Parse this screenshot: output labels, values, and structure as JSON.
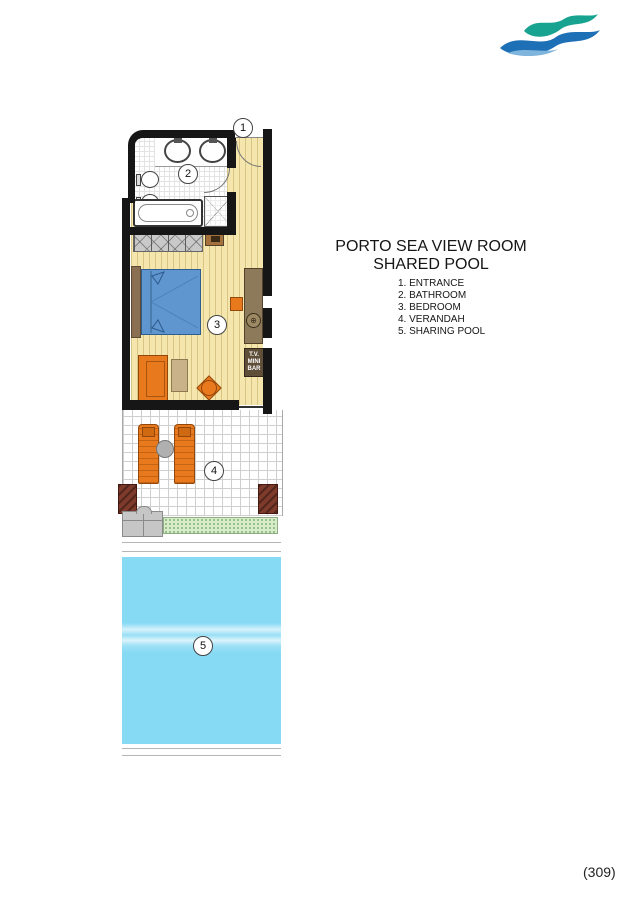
{
  "logo": {
    "brand": "porto elounda",
    "tagline": "GOLF & SPA RESORT",
    "colors": {
      "wave_teal": "#18a390",
      "wave_blue": "#1d6fb6",
      "brand_text": "#23386b",
      "tagline_text": "#a49b89"
    }
  },
  "title": {
    "line1": "PORTO SEA VIEW ROOM",
    "line2": "SHARED POOL"
  },
  "legend": {
    "items": [
      "1. ENTRANCE",
      "2. BATHROOM",
      "3. BEDROOM",
      "4. VERANDAH",
      "5. SHARING POOL"
    ]
  },
  "plan": {
    "markers": [
      "1",
      "2",
      "3",
      "4",
      "5"
    ],
    "tv_cabinet_lines": [
      "T.V.",
      "MINI",
      "BAR"
    ],
    "colors": {
      "wall": "#161616",
      "wood_floor": "#f4e6ac",
      "bed": "#5f96cf",
      "furniture_orange": "#e8791c",
      "furniture_brown": "#8d7a5a",
      "tv_cabinet": "#5f4e38",
      "pillar": "#7e3b2c",
      "planter_green": "#d8ecc9",
      "pool": "#87daf4"
    }
  },
  "page_number": "(309)"
}
